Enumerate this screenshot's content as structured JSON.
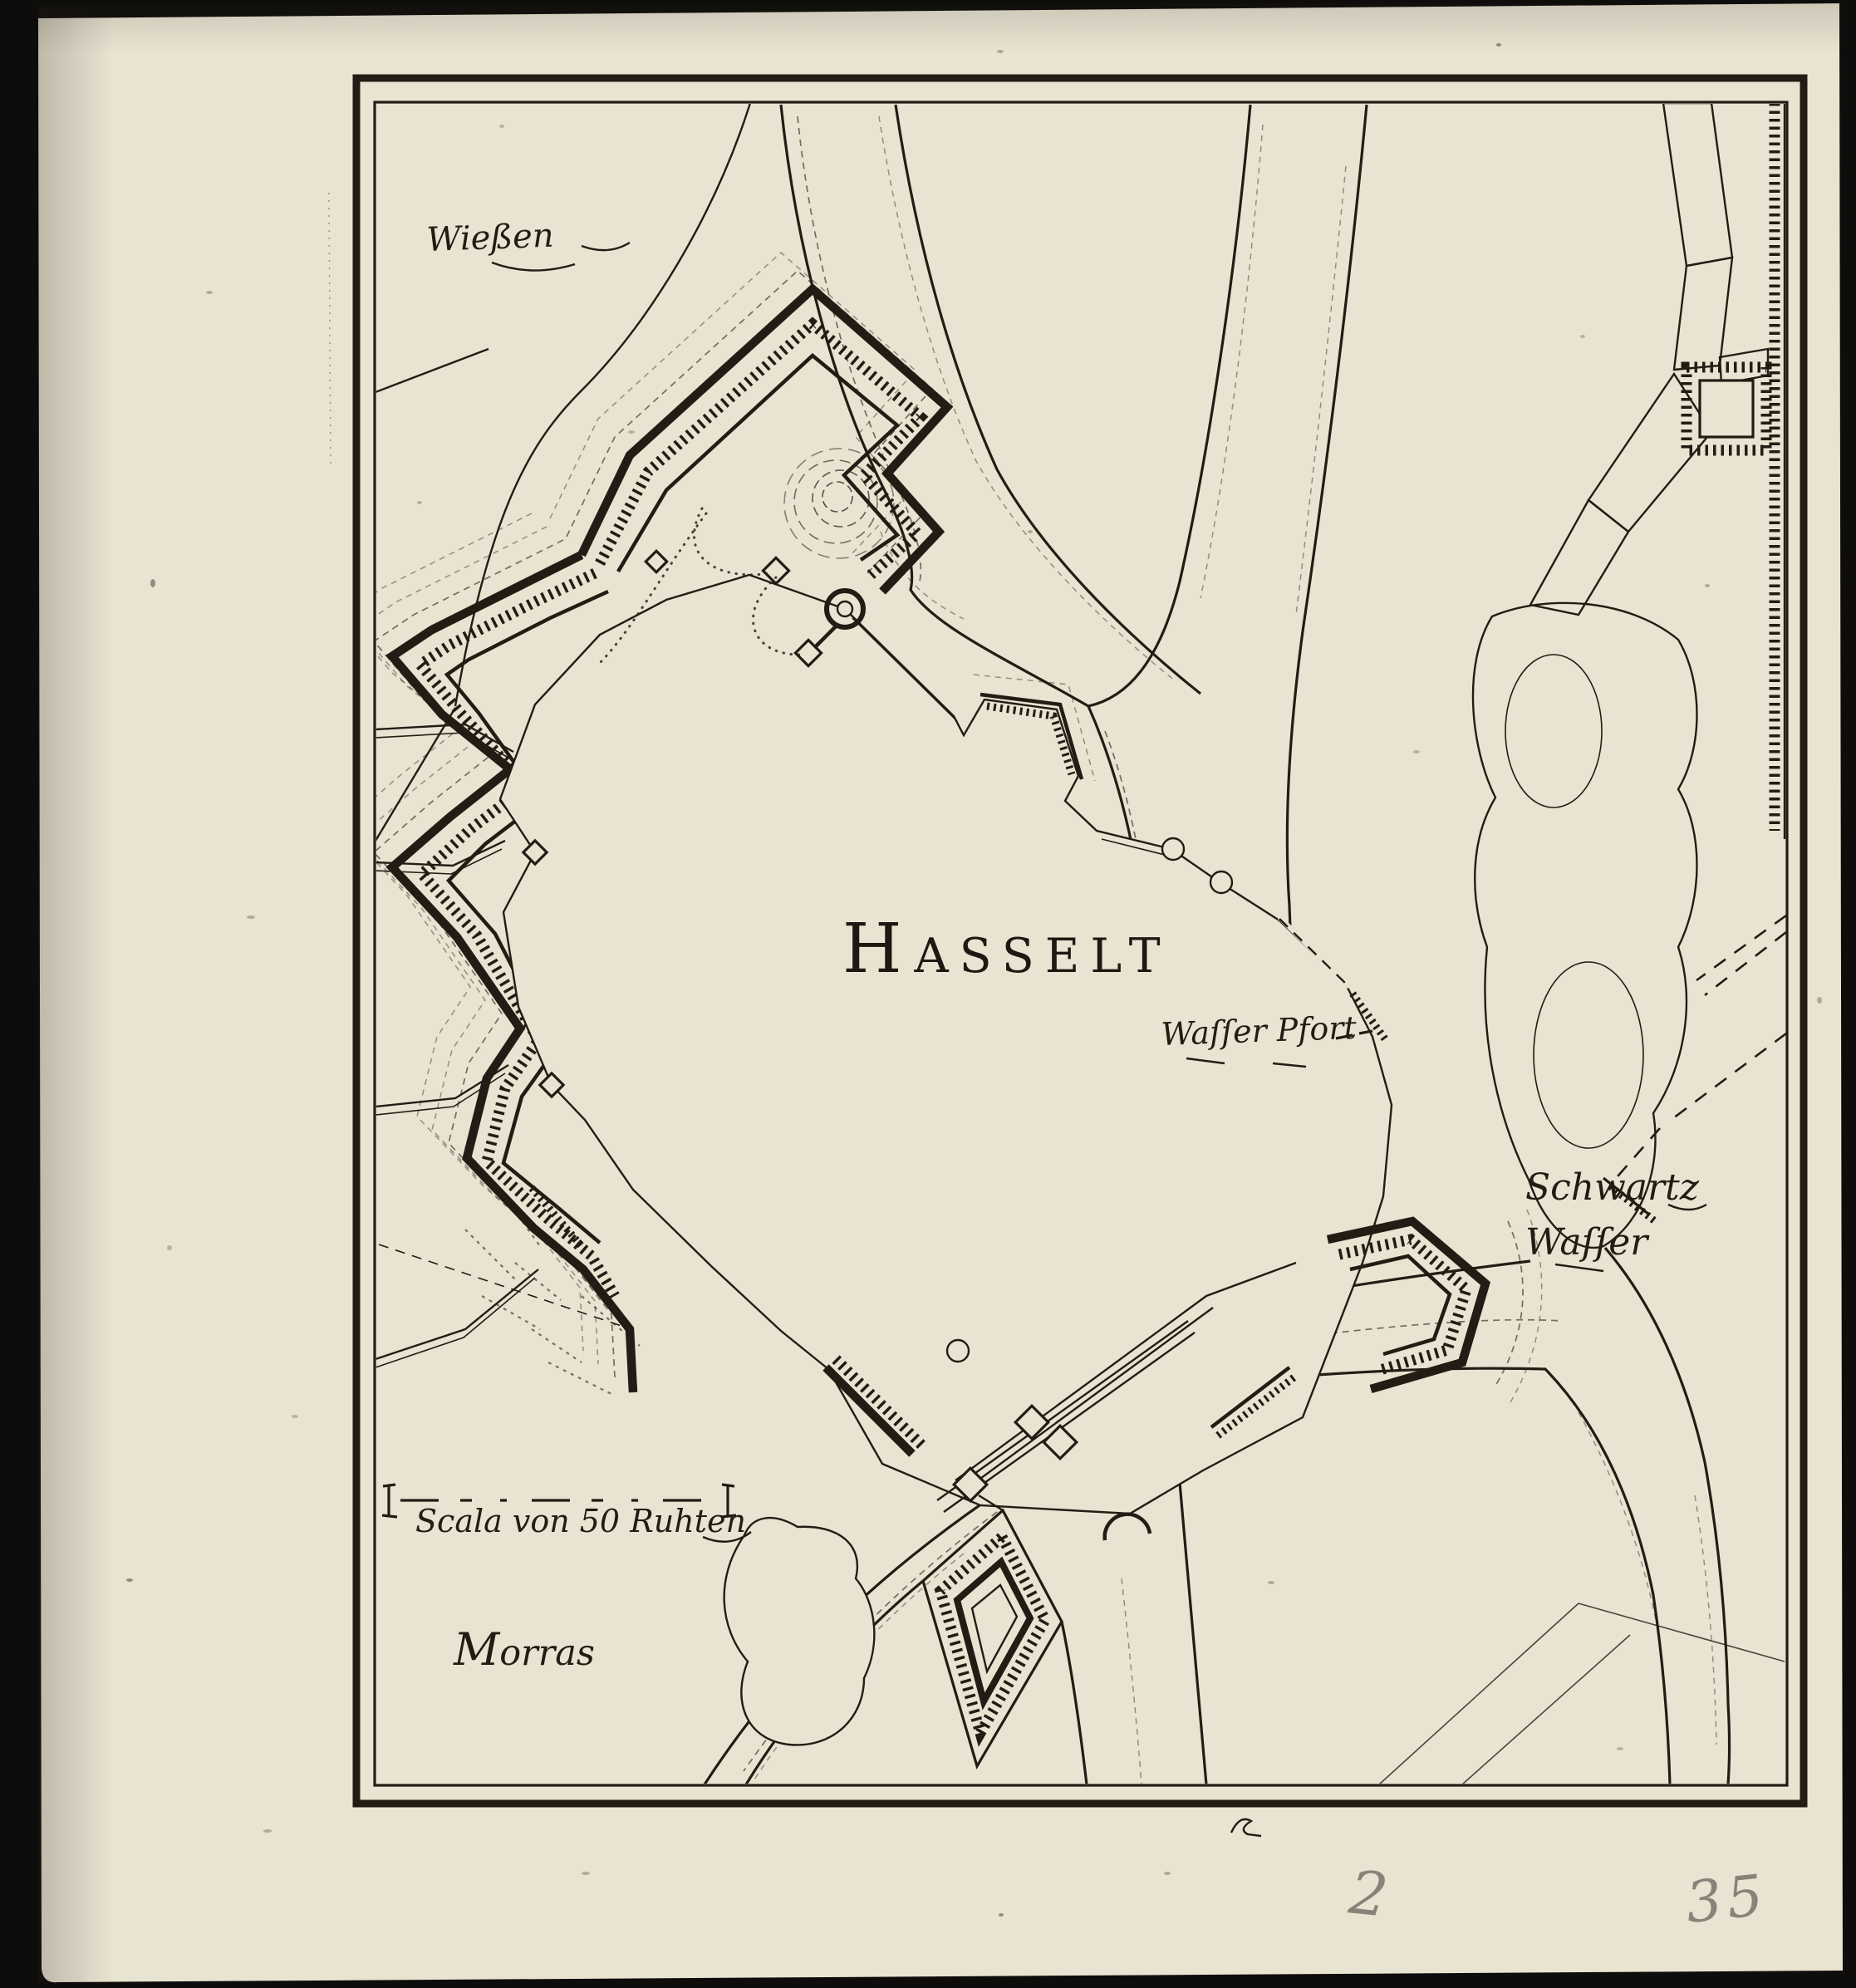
{
  "map": {
    "title": {
      "initial": "H",
      "rest": "ASSELT"
    },
    "region_labels": {
      "wiessen": "Wießen",
      "wasser_pfort": "Waſſer Pfort",
      "schwartz_line1": "Schwartz",
      "schwartz_line2": "Waſſer",
      "morras_initial": "M",
      "morras_rest": "orras"
    },
    "scale_bar": {
      "label": "Scala von 50 Ruhten"
    },
    "handwritten": {
      "left_number": "2",
      "right_number": "35"
    },
    "colors": {
      "paper": "#e9e3d2",
      "ink": "#221c14",
      "background": "#0e0d0b",
      "pencil": "#76736a"
    }
  }
}
